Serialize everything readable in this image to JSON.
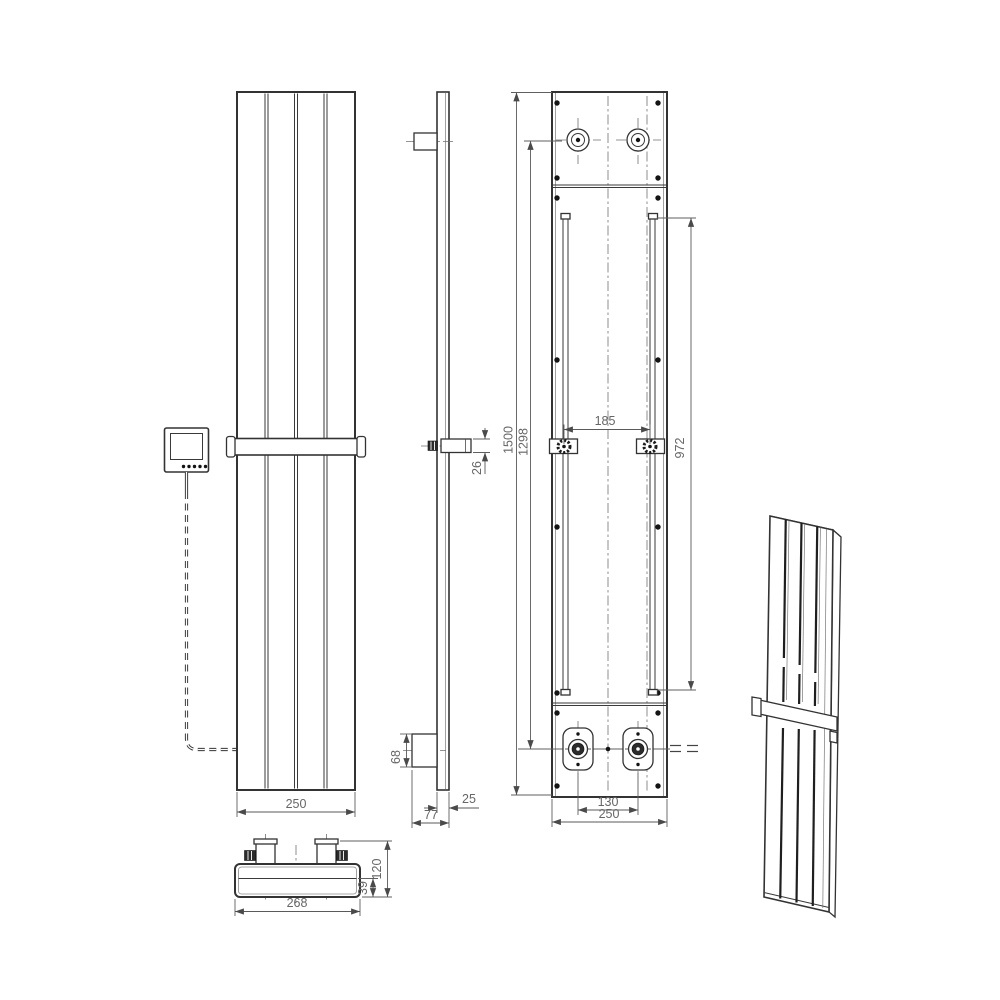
{
  "drawing": {
    "title": "Vertical designer radiator with towel bar - technical drawing",
    "line_color": "#333333",
    "dim_color": "#666666",
    "dims": {
      "front_width": "250",
      "towel_bar_profile": "26",
      "valve_height": "68",
      "panel_depth": "25",
      "total_depth": "77",
      "back_height": "1500",
      "valve_span": "1298",
      "rail_spacing": "185",
      "rail_length": "972",
      "valve_spacing": "130",
      "back_width": "250",
      "top_width": "268",
      "top_depth": "120",
      "top_inner": "39"
    }
  }
}
